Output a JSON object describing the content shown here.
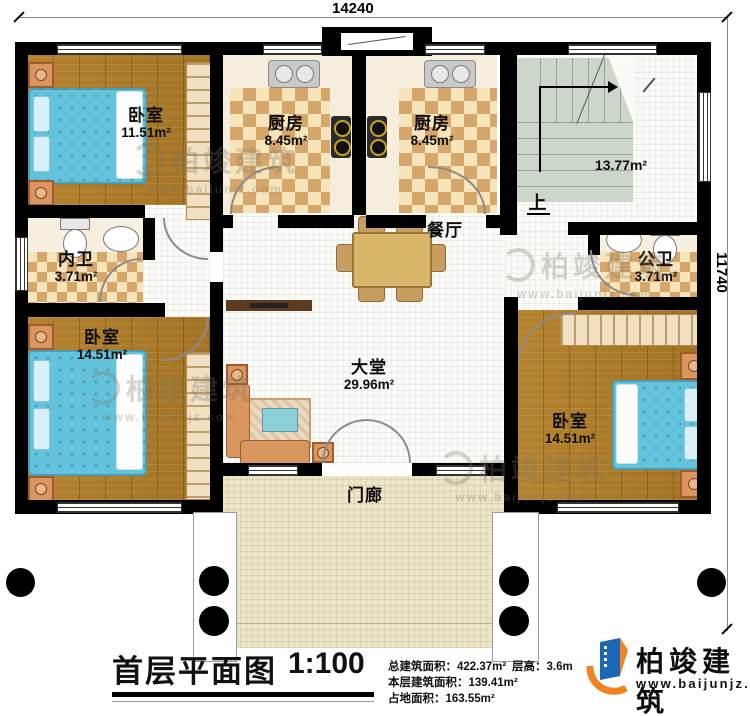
{
  "dimensions": {
    "top": "14240",
    "right": "11740"
  },
  "rooms": {
    "bedroom_tl": {
      "label": "卧室",
      "area": "11.51m²"
    },
    "kitchen_left": {
      "label": "厨房",
      "area": "8.45m²"
    },
    "kitchen_right": {
      "label": "厨房",
      "area": "8.45m²"
    },
    "stair_hall": {
      "area": "13.77m²",
      "up_label": "上"
    },
    "inner_bath": {
      "label": "内卫",
      "area": "3.71m²"
    },
    "dining": {
      "label": "餐厅"
    },
    "public_bath": {
      "label": "公卫",
      "area": "3.71m²"
    },
    "bedroom_bl": {
      "label": "卧室",
      "area": "14.51m²"
    },
    "hall": {
      "label": "大堂",
      "area": "29.96m²"
    },
    "bedroom_br": {
      "label": "卧室",
      "area": "14.51m²"
    },
    "porch": {
      "label": "门廊"
    }
  },
  "footer": {
    "title": "首层平面图",
    "scale": "1:100",
    "stats": [
      {
        "label": "总建筑面积：",
        "value": "422.37m²"
      },
      {
        "label": "本层建筑面积：",
        "value": "139.41m²"
      },
      {
        "label": "占地面积：",
        "value": "163.55m²"
      },
      {
        "label": "层高：",
        "value": "3.6m"
      }
    ],
    "logo": {
      "name": "柏竣建筑",
      "website": "www.baijunjz.com"
    }
  },
  "watermark": {
    "name": "柏竣建筑",
    "website": "www.baijunjz.com"
  },
  "colors": {
    "wall": "#000000",
    "wood": "#ac7b2c",
    "checker_dark": "#d7a66a",
    "checker_light": "#f6e4ba",
    "bed_blue": "#64c3dc",
    "stairs_green": "#ccd6ca",
    "porch_tan": "#ede5c8",
    "furniture_orange": "#d9965e",
    "table_tan": "#d9b56a",
    "logo_blue": "#1b66b5",
    "logo_orange": "#f08220"
  }
}
